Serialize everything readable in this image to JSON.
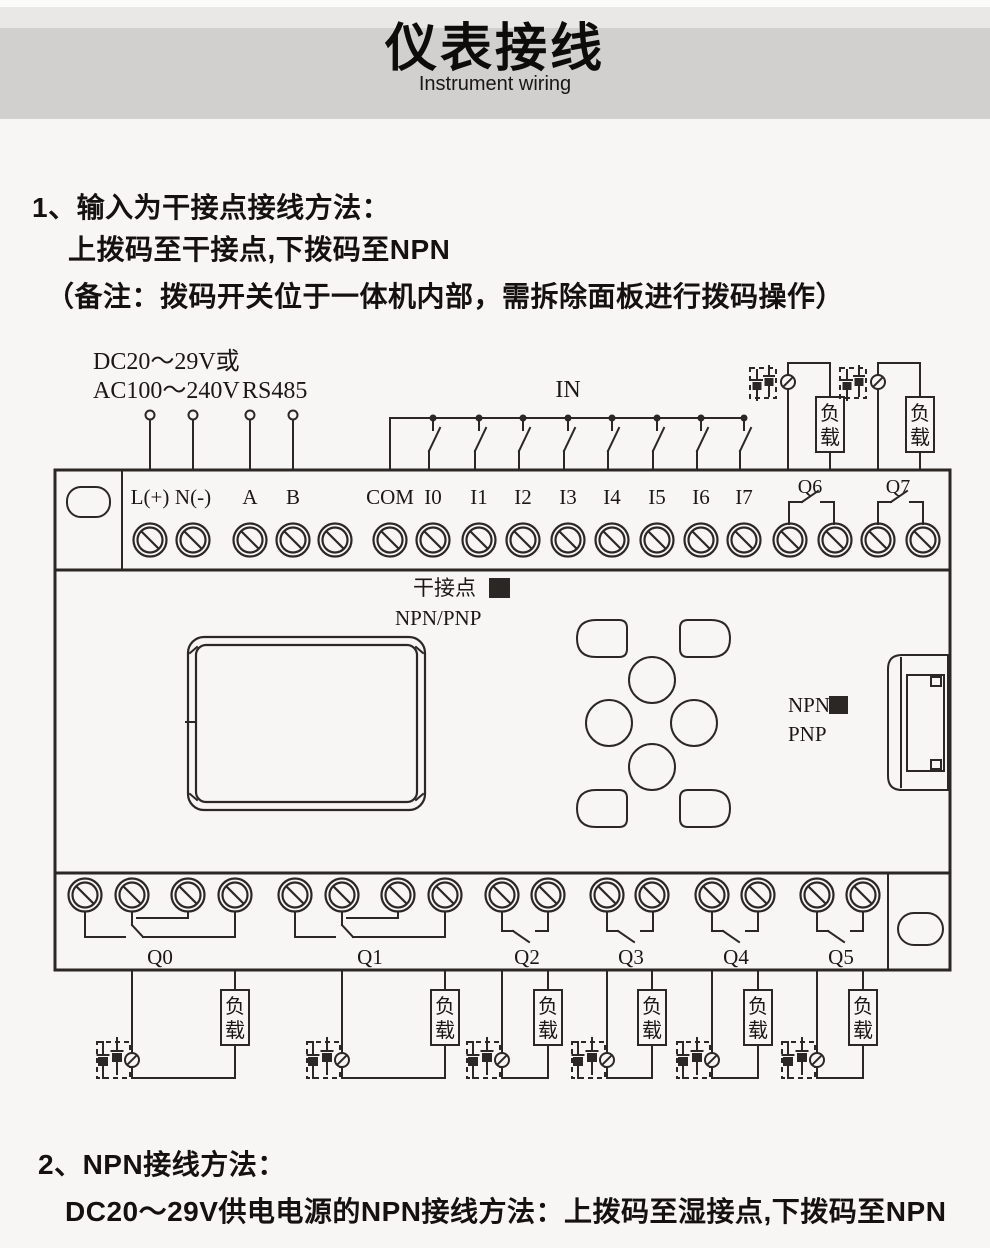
{
  "header": {
    "title": "仪表接线",
    "subtitle": "Instrument wiring"
  },
  "section1": {
    "line1": "1、输入为干接点接线方法：",
    "line2": "上拨码至干接点,下拨码至NPN",
    "line3": "（备注：拨码开关位于一体机内部，需拆除面板进行拨码操作）"
  },
  "section2": {
    "line1": "2、NPN接线方法：",
    "line2": "DC20～29V供电电源的NPN接线方法：上拨码至湿接点,下拨码至NPN"
  },
  "diagram": {
    "power_line1": "DC20～29V或",
    "power_line2": "AC100～240V",
    "rs485": "RS485",
    "in_label": "IN",
    "terminals_top": [
      "L(+)",
      "N(-)",
      "A",
      "B",
      "COM",
      "I0",
      "I1",
      "I2",
      "I3",
      "I4",
      "I5",
      "I6",
      "I7"
    ],
    "relay_top": [
      "Q6",
      "Q7"
    ],
    "relay_bottom": [
      "Q0",
      "Q1",
      "Q2",
      "Q3",
      "Q4",
      "Q5"
    ],
    "dry_contact": "干接点",
    "npn_pnp": "NPN/PNP",
    "npn": "NPN",
    "pnp": "PNP",
    "load": {
      "c1": "负",
      "c2": "载"
    },
    "colors": {
      "line": "#2b2724",
      "text": "#1b1714",
      "header_bg": "#d2d0cf",
      "header_top": "#e9e8e7",
      "page_bg": "#f7f6f4"
    }
  }
}
